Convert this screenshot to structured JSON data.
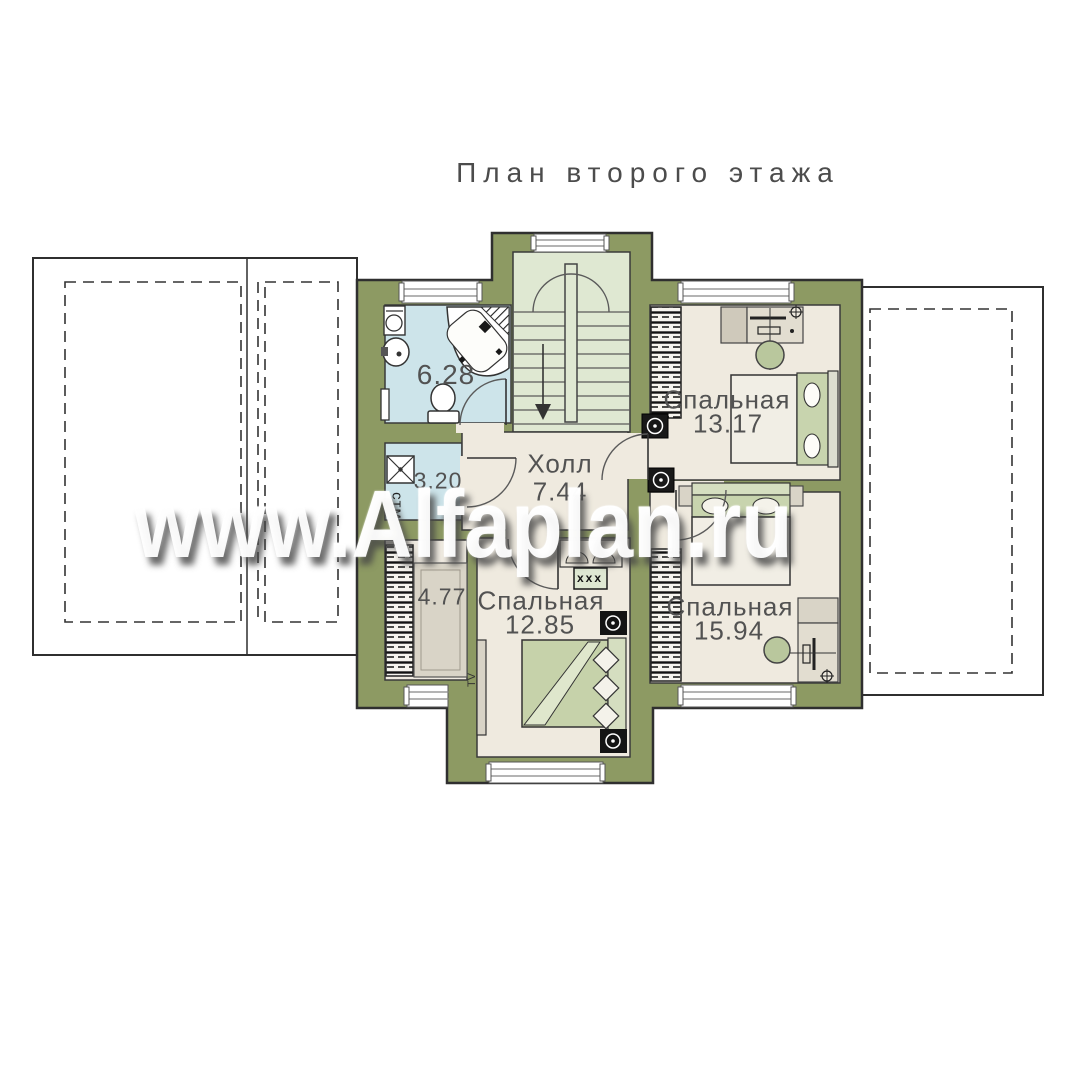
{
  "title": "План второго этажа",
  "watermark": "www.Alfaplan.ru",
  "rooms": {
    "bathroom": {
      "area": "6.28"
    },
    "laundry": {
      "area": "3.20",
      "appliance_label": "стм"
    },
    "hall": {
      "name": "Холл",
      "area": "7.44"
    },
    "closet": {
      "area": "4.77"
    },
    "bedroom_top_right": {
      "name": "Спальная",
      "area": "13.17"
    },
    "bedroom_bottom_right": {
      "name": "Спальная",
      "area": "15.94"
    },
    "bedroom_bottom_left": {
      "name": "Спальная",
      "area": "12.85"
    }
  },
  "symbols": {
    "tv_label": "TV",
    "vent_label": "xxx"
  },
  "colors": {
    "wall": "#8d9a63",
    "floor": "#efeadf",
    "wet_room": "#cde4ea",
    "stairwell": "#dfe8d2",
    "bed_green": "#c6d2aa"
  }
}
